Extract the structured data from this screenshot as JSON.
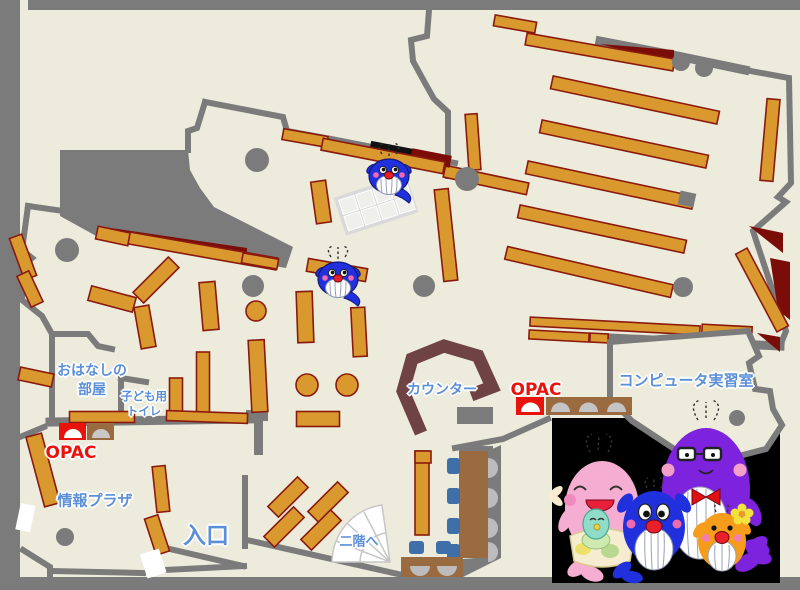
{
  "map_title": "library-first-floor-map",
  "palette": {
    "floor": "#ecebdc",
    "wall": "#7b7b7b",
    "shelf": "#d9992e",
    "shelf_border": "#8a1a0e",
    "carpet_red": "#7a0d08",
    "counter_brown": "#6f4343",
    "desk_brown": "#9a6a41",
    "seat_gray": "#bcbcbc",
    "chair_blue": "#3e6fa8",
    "table_gray": "#d9d9d9",
    "cell_gray": "#efefec",
    "label_blue": "#5b8fd8",
    "opac_red": "#e8130c",
    "photo_black": "#000000",
    "whale_blue": "#2030dd",
    "whale_pink": "#f5aed2",
    "whale_purple": "#7d22dd",
    "whale_orange": "#f59d1a",
    "whale_teal": "#8fdcc8"
  },
  "labels": {
    "story_room": [
      "おはなしの",
      "部屋"
    ],
    "kids_toilet": [
      "子ども用",
      "トイレ"
    ],
    "opac_left": "OPAC",
    "opac_right": "OPAC",
    "info_plaza": "情報プラザ",
    "entrance": "入口",
    "counter": "カウンター",
    "stairs_up": "二階へ",
    "computer_room": "コンピュータ実習室"
  },
  "icons": {
    "whale_mascot": "blue-whale-mascot",
    "family_photo": "whale-family-illustration"
  }
}
